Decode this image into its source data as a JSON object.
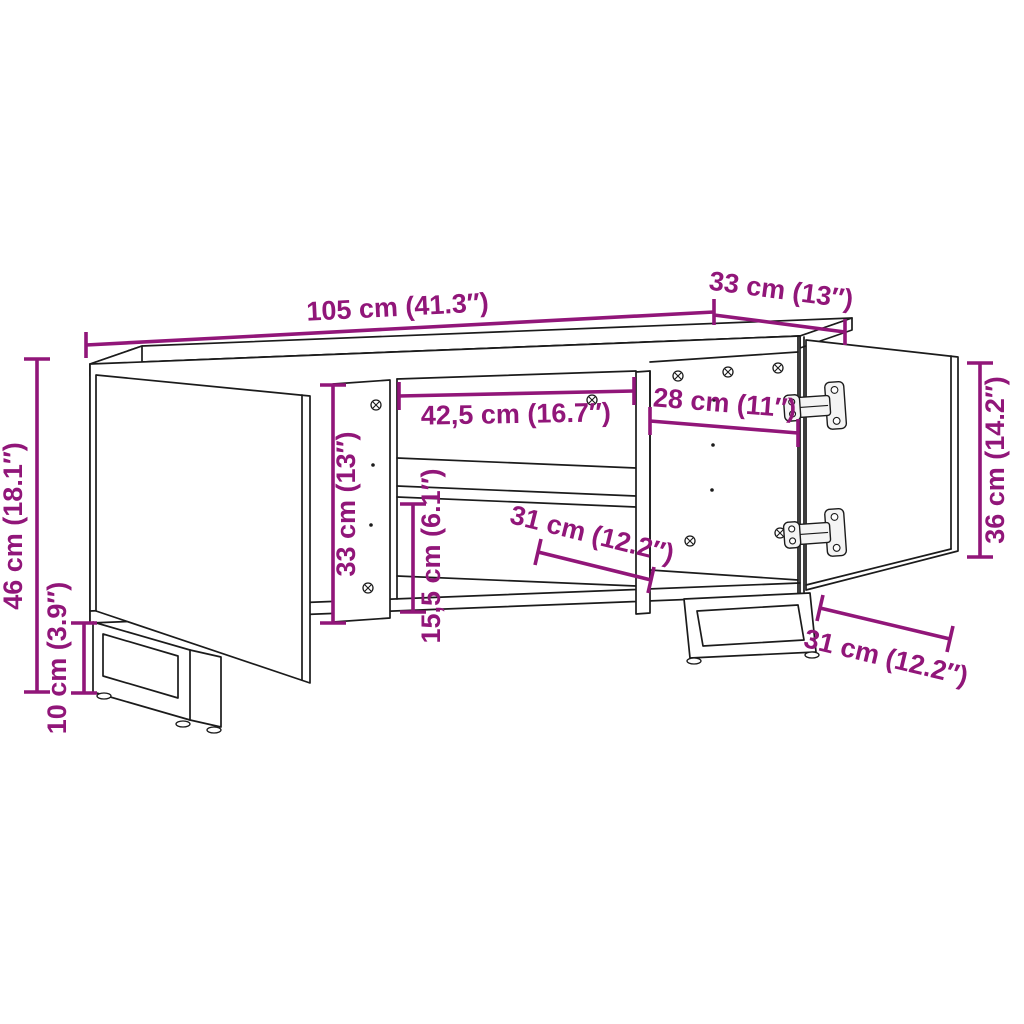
{
  "figure": {
    "subject": "Line drawing of a TV cabinet with a slightly open left door, middle open compartment with shelf, fully open right door with two cup hinges, and two U-shaped sled legs",
    "style": "technical dimension diagram"
  },
  "colors": {
    "dimension": "#911679",
    "line": "#1b1b1b",
    "background": "#ffffff"
  },
  "dimensions": {
    "width_top": {
      "label": "105 cm (41.3″)",
      "cm": "105",
      "inch": "41.3"
    },
    "depth_top": {
      "label": "33 cm (13″)",
      "cm": "33",
      "inch": "13"
    },
    "height_total": {
      "label": "46 cm (18.1″)",
      "cm": "46",
      "inch": "18.1"
    },
    "leg_height": {
      "label": "10 cm (3.9″)",
      "cm": "10",
      "inch": "3.9"
    },
    "interior_height": {
      "label": "33 cm (13″)",
      "cm": "33",
      "inch": "13"
    },
    "middle_width": {
      "label": "42,5 cm (16.7″)",
      "cm": "42,5",
      "inch": "16.7"
    },
    "right_width": {
      "label": "28 cm (11″)",
      "cm": "28",
      "inch": "11"
    },
    "lower_height": {
      "label": "15,5 cm (6.1″)",
      "cm": "15,5",
      "inch": "6.1"
    },
    "interior_depth": {
      "label": "31 cm (12.2″)",
      "cm": "31",
      "inch": "12.2"
    },
    "door_height": {
      "label": "36 cm (14.2″)",
      "cm": "36",
      "inch": "14.2"
    },
    "door_width": {
      "label": "31 cm (12.2″)",
      "cm": "31",
      "inch": "12.2"
    }
  }
}
